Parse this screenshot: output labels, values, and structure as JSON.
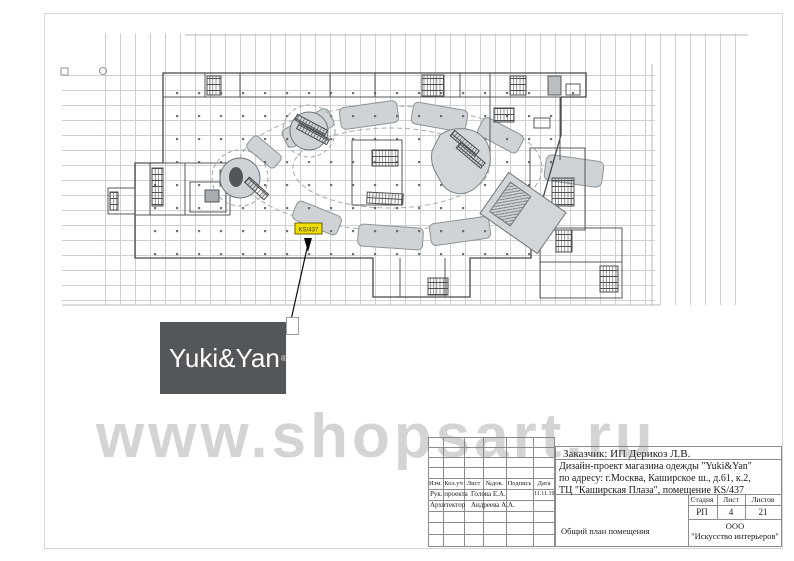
{
  "watermark": {
    "text": "www.shopsart.ru"
  },
  "logo": {
    "text": "Yuki&Yan",
    "reg_mark": "®",
    "bg_color": "#54575a"
  },
  "plan": {
    "unit_highlight": {
      "label": "KS/437",
      "color": "#f0df00"
    }
  },
  "title_block": {
    "customer": "Заказчик: ИП Дерикоз Л.В.",
    "project_lines": [
      "Дизайн-проект магазина одежды \"Yuki&Yan\"",
      "по адресу: г.Москва, Каширское ш., д.61, к.2,",
      "ТЦ \"Каширская Плаза\", помещение KS/437"
    ],
    "revision_table": {
      "headers": [
        "Изм.",
        "Кол.уч",
        "Лист",
        "№док.",
        "Подпись",
        "Дата"
      ],
      "rows": [
        {
          "role": "Рук. проекта",
          "name": "Голова Е.А.",
          "date": "11.11.19"
        },
        {
          "role": "Архитектор",
          "name": "Андреева А.А.",
          "date": ""
        }
      ]
    },
    "stage_table": {
      "headers": [
        "Стадия",
        "Лист",
        "Листов"
      ],
      "values": [
        "РП",
        "4",
        "21"
      ]
    },
    "drawing_title": "Общий план помещения",
    "company_lines": [
      "ООО",
      "\"Искусство интерьеров\""
    ]
  }
}
